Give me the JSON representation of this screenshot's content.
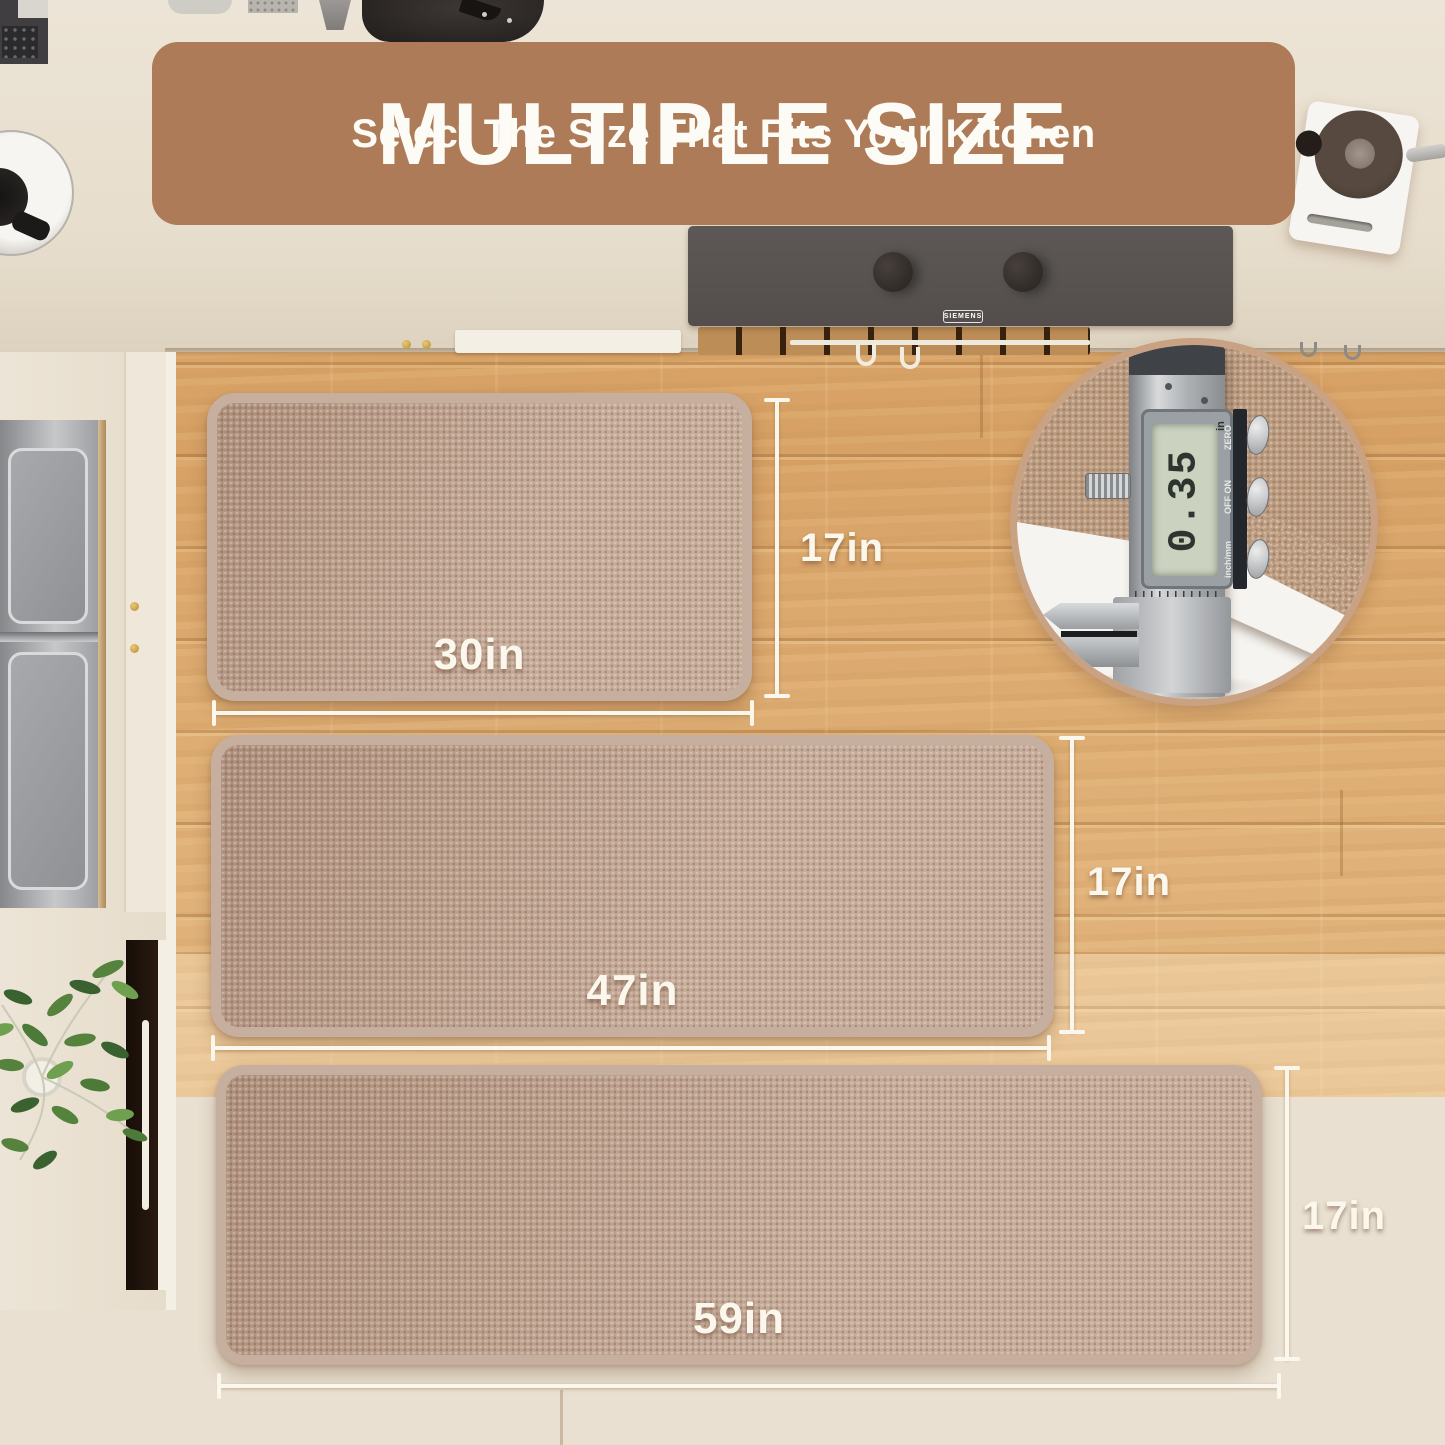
{
  "header": {
    "title": "MULTIPLE SIZE",
    "subtitle": "Select The Size That Fits Your Kitchen"
  },
  "mats": [
    {
      "name": "small mat",
      "width_label": "30in",
      "height_label": "17in"
    },
    {
      "name": "medium runner",
      "width_label": "47in",
      "height_label": "17in"
    },
    {
      "name": "large runner",
      "width_label": "59in",
      "height_label": "17in"
    }
  ],
  "thickness_inset": {
    "caliper_reading": "0.35",
    "caliper_unit": "in",
    "button_labels": [
      "ZERO",
      "OFF ON",
      "inch/mm"
    ]
  },
  "cooktop": {
    "brand": "SIEMENS"
  },
  "colors": {
    "banner": "#ad7b57",
    "banner_text": "#fdfbf5",
    "mat_fill": "#b99c89",
    "mat_border": "#c7af9f",
    "floor": "#d9a76c",
    "dimension_label": "#fbf7ec"
  }
}
